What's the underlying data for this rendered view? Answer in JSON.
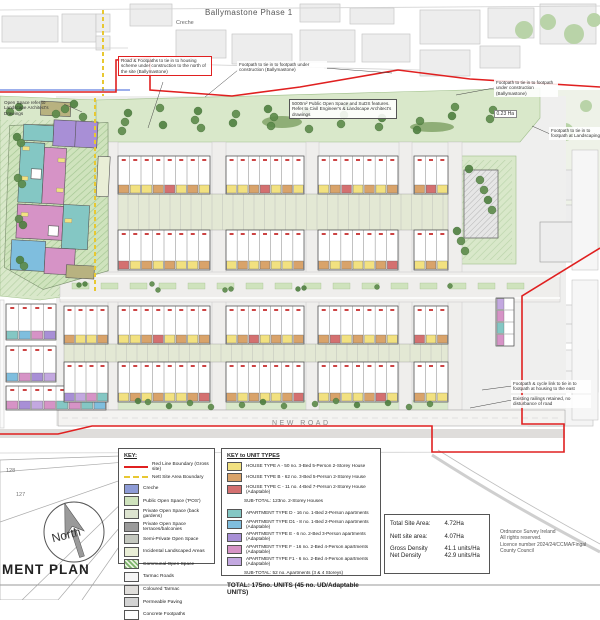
{
  "labels": {
    "phase": "Ballymastone Phase 1",
    "creche": "Creche",
    "new_road": "NEW ROAD",
    "area_1": "0.23 Ha",
    "compass": "North",
    "partial_title": "MENT PLAN",
    "plots": [
      "128",
      "127"
    ]
  },
  "annotations": {
    "road_footpaths": "Road & Footpaths to tie in to housing scheme under construction to the north of the site (Ballymastone)",
    "footpath_top": "Footpath to tie in to footpath under construction (Ballymastone)",
    "footpath_right": "Footpath to tie in to footpath under construction (Ballymastone)",
    "pos_suds": "5000m² Public Open Space and SuDS features. Refer to Civil Engineer's & Landscape Architect's drawings",
    "open_space_left": "Open Space refer to Landscape Architect's Drawings",
    "footpath_landscape": "Footpath to tie in to footpath at Landscaping",
    "footpath_east": "Footpath & cycle link to tie in to footpath at housing to the east",
    "railings": "Existing railings retained, no disturbance of road"
  },
  "legend_key": {
    "title": "KEY:",
    "line_items": [
      {
        "label": "Red Line Boundary (Gross site)",
        "color": "#e02020",
        "style": "solid"
      },
      {
        "label": "Nett Site Area Boundary",
        "color": "#e8c832",
        "style": "dashed"
      }
    ],
    "items": [
      {
        "label": "Creche",
        "color": "#8d9bd6"
      },
      {
        "label": "Public Open Space ('POS')",
        "color": "#cfe3bd"
      },
      {
        "label": "Private Open Space (back gardens)",
        "color": "#dde4d0"
      },
      {
        "label": "Private Open Space terraces/balconies",
        "color": "#9b9b9b"
      },
      {
        "label": "Semi-Private Open Space",
        "color": "#c4c8bf"
      },
      {
        "label": "Incidental Landscaped Areas",
        "color": "#e9eed6"
      },
      {
        "label": "Communal Open Space",
        "color": "#7bb36a",
        "hatch": true
      },
      {
        "label": "Tarmac Roads",
        "color": "#f4f4f4"
      },
      {
        "label": "Coloured Tarmac",
        "color": "#e0dedb"
      },
      {
        "label": "Permeable Paving",
        "color": "#d3d3d3"
      },
      {
        "label": "Concrete Footpaths",
        "color": "#ffffff"
      }
    ]
  },
  "legend_units": {
    "title": "KEY to UNIT TYPES",
    "houses": [
      {
        "code": "A",
        "color": "#f2e180",
        "label": "HOUSE TYPE A - 50 no. 3-Bed 5-Person 2-Storey House"
      },
      {
        "code": "B",
        "color": "#d9a36a",
        "label": "HOUSE TYPE B - 62 no. 3-Bed 5-Person 2-Storey House"
      },
      {
        "code": "C",
        "color": "#d47070",
        "label": "HOUSE TYPE C - 11 no. 4-Bed 7-Person 2-Storey House (Adaptable)"
      }
    ],
    "houses_subtotal": "SUB-TOTAL: 123no. 2-Storey Houses",
    "apartments": [
      {
        "code": "D",
        "color": "#84c7c4",
        "label": "APARTMENT TYPE D - 16 no. 1-Bed 2-Person apartments"
      },
      {
        "code": "D1",
        "color": "#7fbede",
        "label": "APARTMENT TYPE D1 - 8 no. 1-Bed 2-Person apartments (Adaptable)"
      },
      {
        "code": "E",
        "color": "#a88fd6",
        "label": "APARTMENT TYPE E - 6 no. 2-Bed 3-Person apartments (Adaptable)"
      },
      {
        "code": "F",
        "color": "#d693c6",
        "label": "APARTMENT TYPE F - 16 no. 2-Bed 4-Person apartments (Adaptable)"
      },
      {
        "code": "F1",
        "color": "#c3a8e0",
        "label": "APARTMENT TYPE F1 - 6 no. 2-Bed 4-Person apartments (Adaptable)"
      }
    ],
    "apartments_subtotal": "SUB-TOTAL: 52 no. Apartments (3 & 4 Storeys)",
    "total": "TOTAL: 175no. UNITS (45 no. UD/Adaptable UNITS)"
  },
  "site_table": {
    "rows": [
      {
        "label": "Total Site Area:",
        "value": "4.72Ha"
      },
      {
        "label": "Nett site area:",
        "value": "4.07Ha"
      },
      {
        "label": "Gross Density",
        "value": "41.1 units/Ha"
      },
      {
        "label": "Net Density",
        "value": "42.9 units/Ha"
      }
    ]
  },
  "copyright": [
    "Ordnance Survey Ireland",
    "All rights reserved.",
    "Licence number 2024/24/CCMA/Fingal",
    "County Council"
  ],
  "plan": {
    "boundary_color": "#e02020",
    "net_boundary_color": "#e8c832",
    "green": "#d9e8ca",
    "terraces": [
      {
        "x": 118,
        "y": 156,
        "w": 92,
        "h": 38,
        "units": 8
      },
      {
        "x": 226,
        "y": 156,
        "w": 78,
        "h": 38,
        "units": 7
      },
      {
        "x": 318,
        "y": 156,
        "w": 80,
        "h": 38,
        "units": 7
      },
      {
        "x": 414,
        "y": 156,
        "w": 34,
        "h": 38,
        "units": 3
      },
      {
        "x": 118,
        "y": 230,
        "w": 92,
        "h": 40,
        "units": 8
      },
      {
        "x": 226,
        "y": 230,
        "w": 78,
        "h": 40,
        "units": 7
      },
      {
        "x": 318,
        "y": 230,
        "w": 80,
        "h": 40,
        "units": 7
      },
      {
        "x": 414,
        "y": 230,
        "w": 34,
        "h": 40,
        "units": 3
      },
      {
        "x": 64,
        "y": 306,
        "w": 44,
        "h": 38,
        "units": 4
      },
      {
        "x": 118,
        "y": 306,
        "w": 92,
        "h": 38,
        "units": 8
      },
      {
        "x": 226,
        "y": 306,
        "w": 78,
        "h": 38,
        "units": 7
      },
      {
        "x": 318,
        "y": 306,
        "w": 80,
        "h": 38,
        "units": 7
      },
      {
        "x": 414,
        "y": 306,
        "w": 34,
        "h": 38,
        "units": 3
      },
      {
        "x": 118,
        "y": 362,
        "w": 92,
        "h": 40,
        "units": 8
      },
      {
        "x": 226,
        "y": 362,
        "w": 78,
        "h": 40,
        "units": 7
      },
      {
        "x": 318,
        "y": 362,
        "w": 80,
        "h": 40,
        "units": 7
      },
      {
        "x": 414,
        "y": 362,
        "w": 34,
        "h": 40,
        "units": 3
      },
      {
        "x": 6,
        "y": 304,
        "w": 50,
        "h": 36,
        "units": 4,
        "pal": "apt"
      },
      {
        "x": 6,
        "y": 346,
        "w": 50,
        "h": 36,
        "units": 4,
        "pal": "apt"
      },
      {
        "x": 6,
        "y": 386,
        "w": 100,
        "h": 24,
        "units": 8,
        "pal": "apt"
      },
      {
        "x": 64,
        "y": 362,
        "w": 44,
        "h": 40,
        "units": 4,
        "pal": "apt"
      },
      {
        "x": 496,
        "y": 298,
        "w": 18,
        "h": 48,
        "units": 4,
        "pal": "apt",
        "vert": true
      }
    ],
    "gardens": [
      {
        "x": 118,
        "y": 194,
        "w": 330,
        "h": 36
      },
      {
        "x": 64,
        "y": 344,
        "w": 384,
        "h": 18
      }
    ],
    "tree_zones": [
      {
        "x0": 115,
        "x1": 518,
        "y0": 106,
        "y1": 132,
        "n": 26,
        "r": 4
      },
      {
        "x0": 6,
        "x1": 88,
        "y0": 100,
        "y1": 118,
        "n": 6,
        "r": 4
      },
      {
        "x0": 4,
        "x1": 40,
        "y0": 130,
        "y1": 288,
        "n": 8,
        "r": 4
      },
      {
        "x0": 456,
        "x1": 506,
        "y0": 162,
        "y1": 254,
        "n": 8,
        "r": 4
      },
      {
        "x0": 125,
        "x1": 438,
        "y0": 401,
        "y1": 408,
        "n": 14,
        "r": 3
      },
      {
        "x0": 72,
        "x1": 516,
        "y0": 284,
        "y1": 291,
        "n": 10,
        "r": 2.5
      }
    ]
  }
}
